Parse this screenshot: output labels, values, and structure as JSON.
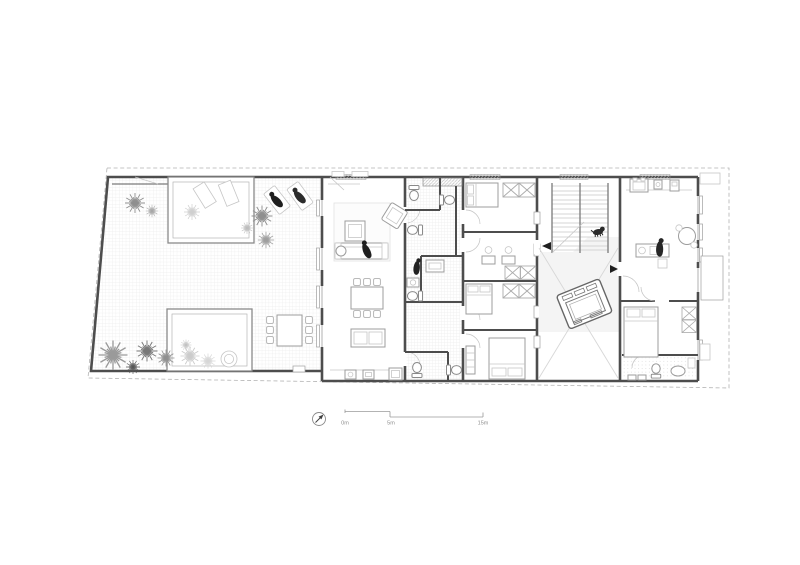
{
  "scale_bar": {
    "label_start": "0m",
    "label_mid": "5m",
    "label_end": "15m"
  },
  "icons": {
    "north_arrow": "north-arrow-icon",
    "entry_markers": "entry-arrow-icon"
  },
  "colors": {
    "paper": "#ffffff",
    "wall": "#4d4d4d",
    "furniture": "#9c9c9c",
    "light": "#c6c6c6",
    "tile": "#e6e6e6",
    "dash": "#b3b3b3",
    "figure": "#1f1f1f",
    "tint": "#f4f4f4"
  }
}
